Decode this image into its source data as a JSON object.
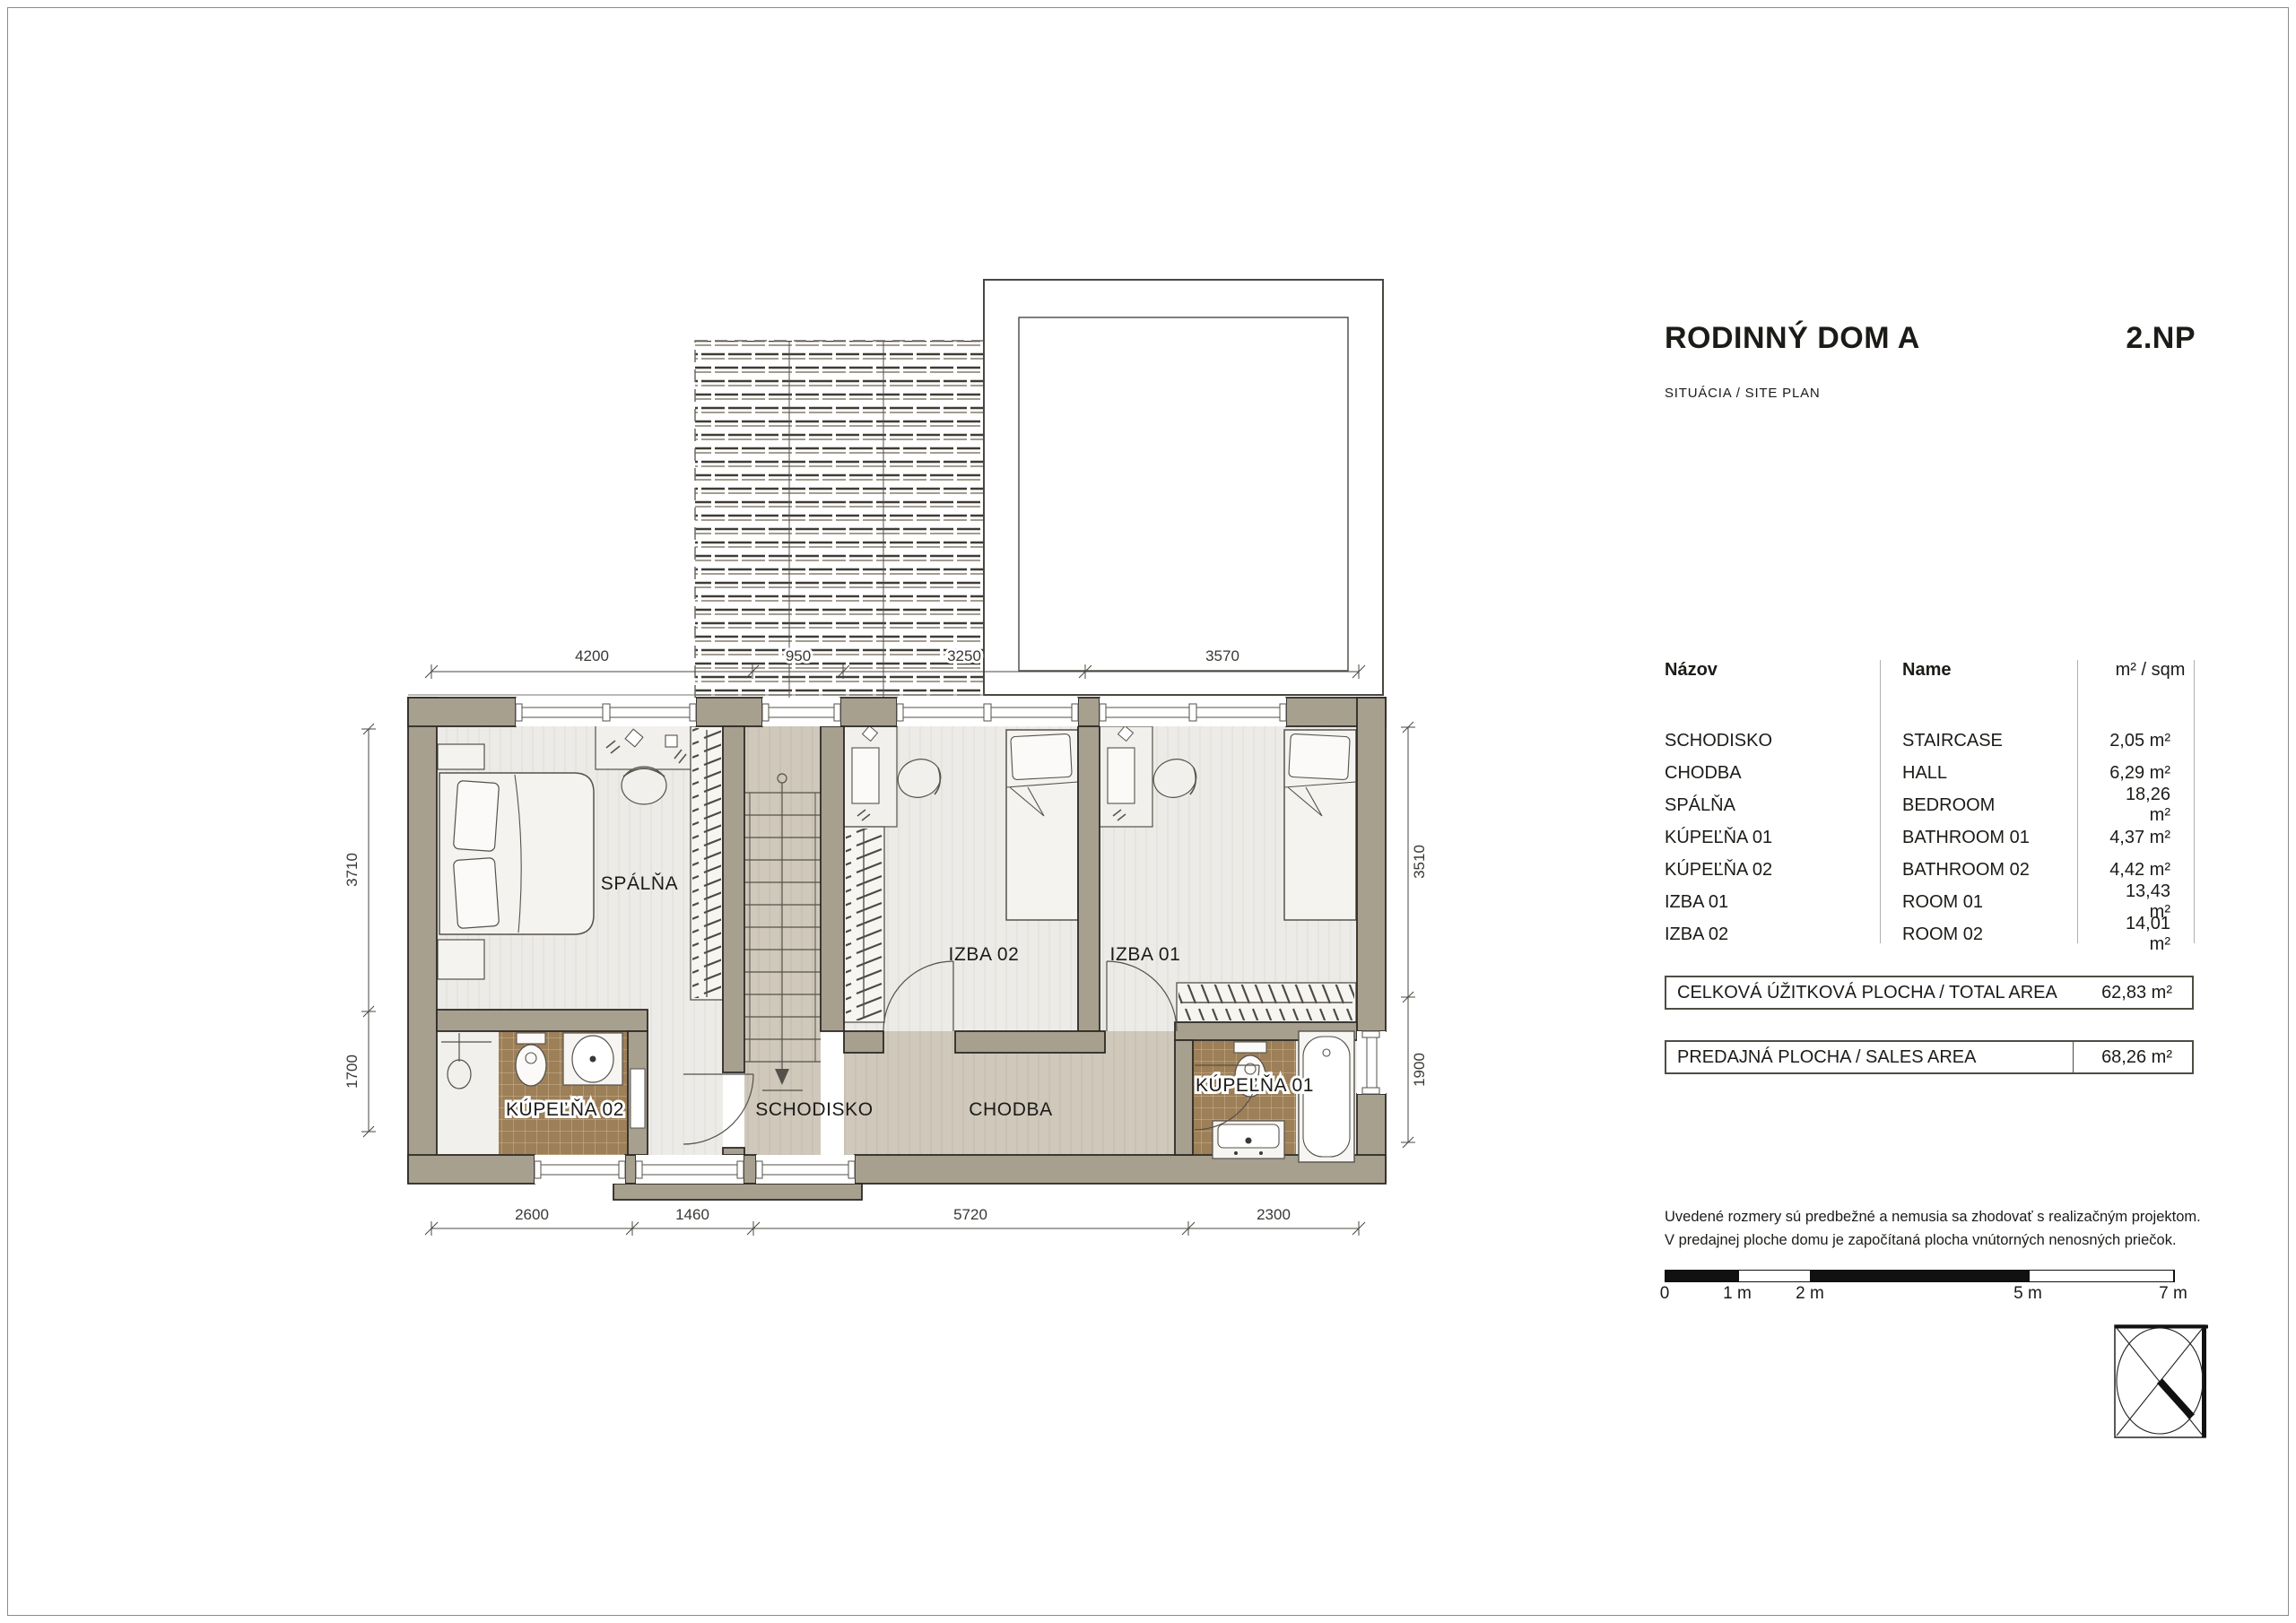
{
  "title_block": {
    "project": "RODINNÝ DOM A",
    "floor": "2.NP",
    "subtitle": "SITUÁCIA / SITE PLAN"
  },
  "room_table": {
    "header": {
      "nazov": "Názov",
      "name": "Name",
      "area": "m² / sqm"
    },
    "rows": [
      {
        "nazov": "SCHODISKO",
        "name": "STAIRCASE",
        "area": "2,05 m²"
      },
      {
        "nazov": "CHODBA",
        "name": "HALL",
        "area": "6,29 m²"
      },
      {
        "nazov": "SPÁLŇA",
        "name": "BEDROOM",
        "area": "18,26 m²"
      },
      {
        "nazov": "KÚPEĽŇA 01",
        "name": "BATHROOM 01",
        "area": "4,37 m²"
      },
      {
        "nazov": "KÚPEĽŇA 02",
        "name": "BATHROOM 02",
        "area": "4,42 m²"
      },
      {
        "nazov": "IZBA 01",
        "name": "ROOM 01",
        "area": "13,43 m²"
      },
      {
        "nazov": "IZBA 02",
        "name": "ROOM 02",
        "area": "14,01 m²"
      }
    ]
  },
  "totals": [
    {
      "label": "CELKOVÁ ÚŽITKOVÁ PLOCHA / TOTAL AREA",
      "value": "62,83 m²"
    },
    {
      "label": "PREDAJNÁ PLOCHA / SALES AREA",
      "value": "68,26 m²"
    }
  ],
  "notes": {
    "line1": "Uvedené rozmery sú predbežné a nemusia sa zhodovať s realizačným projektom.",
    "line2": "V predajnej ploche domu je započítaná plocha vnútorných nenosných priečok."
  },
  "scale_bar": {
    "labels": [
      "0",
      "1 m",
      "2 m",
      "5 m",
      "7 m"
    ]
  },
  "plan": {
    "room_labels": {
      "spalna": "SPÁLŇA",
      "izba02": "IZBA 02",
      "izba01": "IZBA 01",
      "kupelna02": "KÚPEĽŇA 02",
      "schodisko": "SCHODISKO",
      "chodba": "CHODBA",
      "kupelna01": "KÚPEĽŇA 01"
    },
    "dimensions": {
      "top": [
        "4200",
        "950",
        "3250",
        "3570"
      ],
      "bottom": [
        "2600",
        "1460",
        "5720",
        "2300"
      ],
      "left": [
        "3710",
        "1700"
      ],
      "right": [
        "3510",
        "1900"
      ]
    },
    "colors": {
      "wall": "#a7a08f",
      "tile": "#9d7f58",
      "floor_light": "#ecebe7",
      "floor_corridor": "#cfc8bb"
    }
  }
}
